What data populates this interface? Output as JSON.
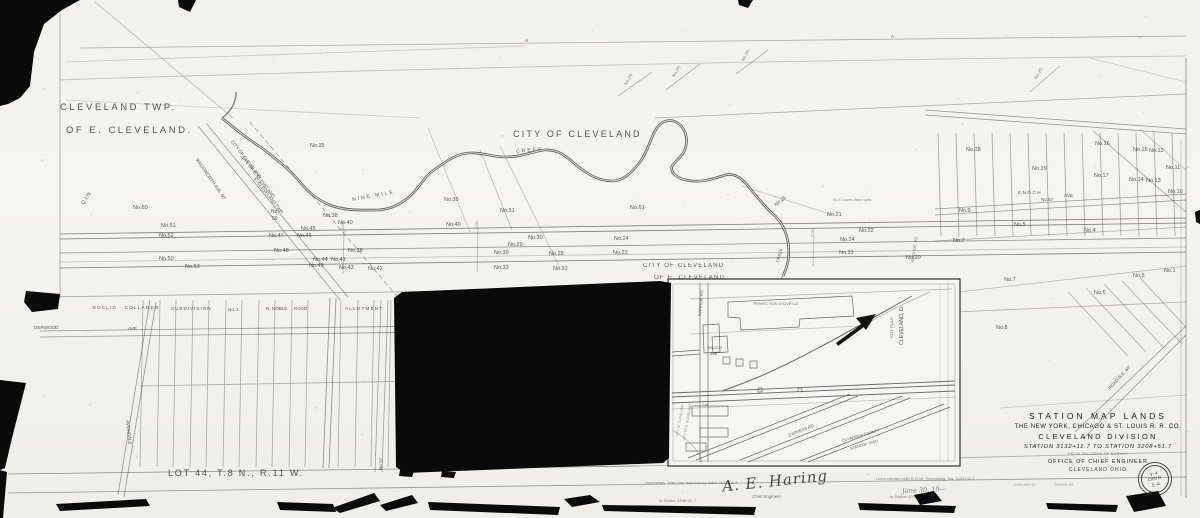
{
  "title_block": {
    "line1": "STATION  MAP   LANDS",
    "line2": "THE NEW YORK, CHICAGO & ST. LOUIS R. R. CO.",
    "line3": "CLEVELAND DIVISION",
    "line4": "STATION 3132+11.7    TO STATION 3208+51.7",
    "line5": "FROM RECORDS OF SURVEY",
    "line6": "OFFICE OF CHIEF  ENGINEER",
    "line7": "CLEVELAND OHIO"
  },
  "stamp": {
    "l1": "V-4",
    "l2": "OHIO",
    "l3": "5-A"
  },
  "notes": {
    "left1": "Horizontals, Main Line from survey notes 3132+11.7",
    "left2": "to Station 3208+51.7",
    "sig": "A. E. Haring",
    "sig_title": "Chief Engineer",
    "right1": "Lines checked with R.O.W.  Remaining  Sta. 3132+11.7",
    "right2": "to Station 3208+51.7",
    "right3": "June 30, 19—"
  },
  "map": {
    "labels": [
      {
        "t": "CLEVELAND TWP.",
        "x": 60,
        "y": 103,
        "s": 9.5,
        "ls": 2.5
      },
      {
        "t": "OF E. CLEVELAND.",
        "x": 66,
        "y": 126,
        "s": 9.5,
        "ls": 2.5
      },
      {
        "t": "CITY OF CLEVELAND",
        "x": 513,
        "y": 130,
        "s": 9,
        "ls": 2.2,
        "n": "city-of-cleveland-label"
      },
      {
        "t": "LOT 44, T.8 N., R.11 W.",
        "x": 168,
        "y": 469,
        "s": 9,
        "ls": 1.8,
        "n": "lot-44-label"
      },
      {
        "t": "CITY OF CLEVELAND",
        "x": 643,
        "y": 263,
        "s": 6,
        "ls": 1.2
      },
      {
        "t": "OF E. CLEVELAND",
        "x": 654,
        "y": 275,
        "s": 6,
        "ls": 1.2
      },
      {
        "t": "CITY OF CLEVELAND",
        "x": 233,
        "y": 140,
        "s": 4.6,
        "r": 52
      },
      {
        "t": "CITY OF E. CLEVELAND",
        "x": 243,
        "y": 155,
        "s": 4.6,
        "r": 52
      },
      {
        "t": "E. CLEVELAND TWP.",
        "x": 256,
        "y": 177,
        "s": 4.6,
        "r": 52
      },
      {
        "t": "WADSWORTH AVE. 60'",
        "x": 198,
        "y": 158,
        "s": 4.6,
        "r": 55
      },
      {
        "t": "NINE MILE",
        "x": 352,
        "y": 198,
        "s": 5,
        "r": -10,
        "ls": 2,
        "n": "creek-label"
      },
      {
        "t": "CREEK",
        "x": 516,
        "y": 150,
        "s": 5,
        "r": -6,
        "ls": 2,
        "n": "creek-label"
      },
      {
        "t": "CREEK",
        "x": 776,
        "y": 262,
        "s": 4.2,
        "r": -75,
        "n": "creek-label"
      },
      {
        "t": "No.35",
        "x": 310,
        "y": 144,
        "s": 5.5
      },
      {
        "t": "No.39",
        "x": 444,
        "y": 198,
        "s": 5.5
      },
      {
        "t": "No.31",
        "x": 500,
        "y": 209,
        "s": 5.5
      },
      {
        "t": "No.61",
        "x": 630,
        "y": 206,
        "s": 5.5
      },
      {
        "t": "No.60",
        "x": 133,
        "y": 206,
        "s": 5.5
      },
      {
        "t": "Q.178",
        "x": 81,
        "y": 203,
        "s": 5,
        "r": -55
      },
      {
        "t": "No.51",
        "x": 161,
        "y": 224,
        "s": 5.5
      },
      {
        "t": "No.52",
        "x": 159,
        "y": 234,
        "s": 5.5
      },
      {
        "t": "No.50",
        "x": 159,
        "y": 257,
        "s": 5.5
      },
      {
        "t": "No.53",
        "x": 185,
        "y": 265,
        "s": 5.5
      },
      {
        "t": "No",
        "x": 271,
        "y": 210,
        "s": 5
      },
      {
        "t": "59",
        "x": 272,
        "y": 217,
        "s": 5
      },
      {
        "t": "No.38",
        "x": 323,
        "y": 214,
        "s": 5.5
      },
      {
        "t": "No.40",
        "x": 338,
        "y": 221,
        "s": 5.5
      },
      {
        "t": "No.45",
        "x": 301,
        "y": 227,
        "s": 5.5
      },
      {
        "t": "No.47",
        "x": 269,
        "y": 234,
        "s": 5.5
      },
      {
        "t": "No.46",
        "x": 297,
        "y": 234,
        "s": 5.5
      },
      {
        "t": "No.48",
        "x": 274,
        "y": 249,
        "s": 5.5
      },
      {
        "t": "No.38",
        "x": 348,
        "y": 249,
        "s": 5.5
      },
      {
        "t": "No.44",
        "x": 313,
        "y": 258,
        "s": 5.5
      },
      {
        "t": "No.41",
        "x": 331,
        "y": 258,
        "s": 5.5
      },
      {
        "t": "No.49",
        "x": 309,
        "y": 264,
        "s": 5.5
      },
      {
        "t": "No.43",
        "x": 339,
        "y": 266,
        "s": 5.5
      },
      {
        "t": "No.42",
        "x": 368,
        "y": 267,
        "s": 5.5
      },
      {
        "t": "No.40",
        "x": 446,
        "y": 223,
        "s": 5.5
      },
      {
        "t": "No.30",
        "x": 528,
        "y": 236,
        "s": 5.5
      },
      {
        "t": "No.29",
        "x": 508,
        "y": 243,
        "s": 5.5
      },
      {
        "t": "No.39",
        "x": 494,
        "y": 251,
        "s": 5.5
      },
      {
        "t": "No.28",
        "x": 549,
        "y": 252,
        "s": 5.5
      },
      {
        "t": "No.24",
        "x": 614,
        "y": 237,
        "s": 5.5
      },
      {
        "t": "No.23",
        "x": 613,
        "y": 251,
        "s": 5.5
      },
      {
        "t": "No.33",
        "x": 494,
        "y": 266,
        "s": 5.5
      },
      {
        "t": "No.32",
        "x": 553,
        "y": 267,
        "s": 5.5
      },
      {
        "t": "No.25",
        "x": 774,
        "y": 204,
        "s": 5,
        "r": -38
      },
      {
        "t": "No.21",
        "x": 827,
        "y": 213,
        "s": 5.5
      },
      {
        "t": "No.22",
        "x": 859,
        "y": 229,
        "s": 5.5
      },
      {
        "t": "No.24",
        "x": 840,
        "y": 238,
        "s": 5.5
      },
      {
        "t": "No.23",
        "x": 839,
        "y": 251,
        "s": 5.5
      },
      {
        "t": "No.20",
        "x": 906,
        "y": 256,
        "s": 5.5
      },
      {
        "t": "No.9",
        "x": 959,
        "y": 209,
        "s": 5.5
      },
      {
        "t": "No.7",
        "x": 953,
        "y": 239,
        "s": 5.5
      },
      {
        "t": "No.18",
        "x": 966,
        "y": 148,
        "s": 5.5
      },
      {
        "t": "No.16",
        "x": 1095,
        "y": 142,
        "s": 5.5
      },
      {
        "t": "No.15",
        "x": 1133,
        "y": 148,
        "s": 5.5
      },
      {
        "t": "No.12",
        "x": 1149,
        "y": 149,
        "s": 5.5
      },
      {
        "t": "No.19",
        "x": 1032,
        "y": 167,
        "s": 5.5
      },
      {
        "t": "No.17",
        "x": 1094,
        "y": 174,
        "s": 5.5
      },
      {
        "t": "No.14",
        "x": 1129,
        "y": 178,
        "s": 5.5
      },
      {
        "t": "No.13",
        "x": 1146,
        "y": 179,
        "s": 5.5
      },
      {
        "t": "No.11",
        "x": 1166,
        "y": 166,
        "s": 5.5
      },
      {
        "t": "No.10",
        "x": 1168,
        "y": 190,
        "s": 5.5
      },
      {
        "t": "No.5",
        "x": 1014,
        "y": 223,
        "s": 5.5
      },
      {
        "t": "No.4",
        "x": 1084,
        "y": 229,
        "s": 5.5
      },
      {
        "t": "ENOCH",
        "x": 1018,
        "y": 191,
        "s": 4.6,
        "ls": 1.5
      },
      {
        "t": "No.57",
        "x": 1041,
        "y": 198,
        "s": 4.6
      },
      {
        "t": "AVE.",
        "x": 1064,
        "y": 194,
        "s": 4.6
      },
      {
        "t": "No.7",
        "x": 1004,
        "y": 278,
        "s": 5.5
      },
      {
        "t": "No.6",
        "x": 1094,
        "y": 291,
        "s": 5.5
      },
      {
        "t": "No.8",
        "x": 996,
        "y": 326,
        "s": 5.5
      },
      {
        "t": "No.5",
        "x": 1133,
        "y": 274,
        "s": 5.5
      },
      {
        "t": "No.1",
        "x": 1164,
        "y": 269,
        "s": 5.5
      },
      {
        "t": "ROAD N.E. 60'",
        "x": 1108,
        "y": 388,
        "s": 4.6,
        "r": -48
      },
      {
        "t": "No.29",
        "x": 624,
        "y": 84,
        "s": 4.6,
        "r": -60,
        "o": 0.6
      },
      {
        "t": "No.25",
        "x": 672,
        "y": 76,
        "s": 4.6,
        "r": -60,
        "o": 0.6
      },
      {
        "t": "No.26",
        "x": 741,
        "y": 60,
        "s": 4.6,
        "r": -60,
        "o": 0.6
      },
      {
        "t": "No.25",
        "x": 1034,
        "y": 78,
        "s": 4.6,
        "r": -60,
        "o": 0.6
      },
      {
        "t": "A",
        "x": 525,
        "y": 40,
        "s": 4.8
      },
      {
        "t": "A",
        "x": 891,
        "y": 36,
        "s": 4.8
      },
      {
        "t": "No.37",
        "x": 379,
        "y": 470,
        "s": 4.6,
        "r": -87
      },
      {
        "t": "EUCLID - COLLAMER",
        "x": 93,
        "y": 306,
        "s": 4.6,
        "ls": 1.2
      },
      {
        "t": "SUBDIVISION",
        "x": 171,
        "y": 307,
        "s": 4.6,
        "ls": 1
      },
      {
        "t": "No. 1",
        "x": 228,
        "y": 308,
        "s": 4.6
      },
      {
        "t": "N. NOBLE",
        "x": 266,
        "y": 307,
        "s": 4.6
      },
      {
        "t": "ROAD",
        "x": 294,
        "y": 307,
        "s": 4.6
      },
      {
        "t": "ALLOTMENT",
        "x": 345,
        "y": 307,
        "s": 4.6,
        "ls": 1.2
      },
      {
        "t": "DERWOOD",
        "x": 34,
        "y": 326,
        "s": 4.6
      },
      {
        "t": "AVE.",
        "x": 128,
        "y": 327,
        "s": 4.6
      },
      {
        "t": "AVONDALE",
        "x": 129,
        "y": 420,
        "s": 4.6,
        "r": 84
      },
      {
        "t": "IVANHOE RD.",
        "x": 911,
        "y": 262,
        "s": 4.2,
        "r": -82,
        "o": 0.6
      },
      {
        "t": "No.21 covers these rights",
        "x": 833,
        "y": 199,
        "s": 3.4,
        "o": 0.55
      },
      {
        "t": "3150",
        "x": 342,
        "y": 230,
        "s": 3.8,
        "r": -90,
        "o": 0.55
      },
      {
        "t": "3160",
        "x": 476,
        "y": 229,
        "s": 3.8,
        "r": -90,
        "o": 0.55
      },
      {
        "t": "3180",
        "x": 812,
        "y": 237,
        "s": 3.8,
        "r": -90,
        "o": 0.55
      },
      {
        "t": "CHECKED BY",
        "x": 1014,
        "y": 484,
        "s": 3.4,
        "o": 0.45
      },
      {
        "t": "TRACED BY",
        "x": 1054,
        "y": 484,
        "s": 3.4,
        "o": 0.45
      }
    ],
    "inset_labels": [
      {
        "t": "PERFECTION STOVE CO.",
        "x": 753,
        "y": 303,
        "s": 3.8,
        "o": 0.7,
        "n": "inset-building-label"
      },
      {
        "t": "IVANHOE RD.",
        "x": 698,
        "y": 316,
        "s": 4.2,
        "r": -85,
        "n": "inset-street-label"
      },
      {
        "t": "ENOCH",
        "x": 708,
        "y": 347,
        "s": 3.8,
        "n": "inset-street-label"
      },
      {
        "t": "AVE.",
        "x": 710,
        "y": 353,
        "s": 3.8,
        "n": "inset-street-label"
      },
      {
        "t": "CITY PLAN",
        "x": 890,
        "y": 338,
        "s": 4,
        "r": -90,
        "n": "inset-title-label"
      },
      {
        "t": "CLEVELAND, O.",
        "x": 900,
        "y": 345,
        "s": 5.2,
        "r": -90,
        "n": "inset-title-label"
      },
      {
        "t": "EXPRESS RD",
        "x": 788,
        "y": 434,
        "s": 4.2,
        "r": -22,
        "n": "inset-street-label"
      },
      {
        "t": "CUYAHOGA COUNTY",
        "x": 842,
        "y": 440,
        "s": 3.8,
        "r": -16
      },
      {
        "t": "STATE OF OHIO",
        "x": 850,
        "y": 448,
        "s": 3.8,
        "r": -16
      },
      {
        "t": "THE",
        "x": 702,
        "y": 404,
        "s": 3.4,
        "o": 0.6
      },
      {
        "t": "CITY OF CLEVELAND",
        "x": 676,
        "y": 436,
        "s": 3.2,
        "r": -80,
        "o": 0.55
      },
      {
        "t": "CITY OF E. CLEVELAND",
        "x": 683,
        "y": 440,
        "s": 3.2,
        "r": -80,
        "o": 0.55
      }
    ]
  }
}
